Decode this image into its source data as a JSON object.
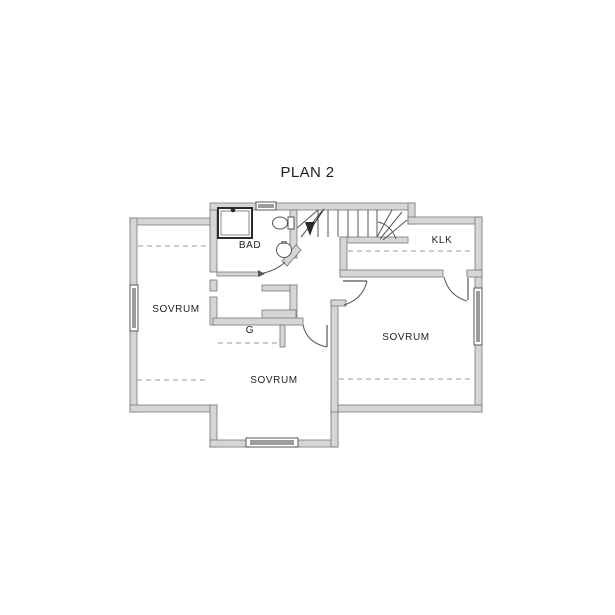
{
  "title": "PLAN 2",
  "colors": {
    "background": "#ffffff",
    "wall_fill": "#d6d6d6",
    "wall_stroke": "#767676",
    "line": "#555555",
    "dark": "#2a2a2a",
    "window_band": "#9c9c9c",
    "dashed": "#999999",
    "text": "#1f1f1f"
  },
  "rooms": [
    {
      "name": "bad",
      "label": "BAD",
      "x": 250,
      "y": 248
    },
    {
      "name": "klk",
      "label": "KLK",
      "x": 442,
      "y": 243
    },
    {
      "name": "sovrum-left",
      "label": "SOVRUM",
      "x": 176,
      "y": 312
    },
    {
      "name": "sovrum-right",
      "label": "SOVRUM",
      "x": 406,
      "y": 340
    },
    {
      "name": "sovrum-center",
      "label": "SOVRUM",
      "x": 274,
      "y": 383
    },
    {
      "name": "garderob",
      "label": "G",
      "x": 250,
      "y": 333
    }
  ],
  "plan": {
    "walls": [
      [
        130,
        218,
        87,
        7
      ],
      [
        130,
        218,
        7,
        194
      ],
      [
        130,
        405,
        87,
        7
      ],
      [
        210,
        203,
        205,
        7
      ],
      [
        408,
        203,
        7,
        21
      ],
      [
        408,
        217,
        74,
        7
      ],
      [
        475,
        217,
        7,
        195
      ],
      [
        331,
        405,
        151,
        7
      ],
      [
        210,
        405,
        7,
        42
      ],
      [
        210,
        440,
        128,
        7
      ],
      [
        331,
        405,
        7,
        42
      ],
      [
        210,
        210,
        7,
        62
      ],
      [
        210,
        280,
        7,
        11
      ],
      [
        210,
        297,
        7,
        28
      ],
      [
        290,
        210,
        7,
        48
      ],
      [
        340,
        237,
        68,
        6
      ],
      [
        340,
        237,
        7,
        40
      ],
      [
        340,
        270,
        103,
        7
      ],
      [
        467,
        270,
        15,
        7
      ],
      [
        217,
        272,
        42,
        4
      ],
      [
        262,
        285,
        35,
        6
      ],
      [
        290,
        285,
        7,
        32
      ],
      [
        262,
        310,
        34,
        14
      ],
      [
        213,
        318,
        90,
        7
      ],
      [
        280,
        325,
        5,
        22
      ],
      [
        331,
        300,
        7,
        112
      ],
      [
        331,
        300,
        15,
        6
      ]
    ],
    "diagonal_wall": "282,261 296,245 301,250 287,266",
    "stairs": {
      "treads": [
        [
          318,
          210,
          318,
          237
        ],
        [
          328,
          210,
          328,
          237
        ],
        [
          338,
          210,
          338,
          237
        ],
        [
          348,
          210,
          348,
          237
        ],
        [
          358,
          210,
          358,
          237
        ],
        [
          368,
          210,
          368,
          237
        ],
        [
          377,
          210,
          377,
          237
        ]
      ],
      "winders": [
        [
          297,
          228,
          318,
          210
        ],
        [
          301,
          237,
          322,
          211
        ],
        [
          377,
          237,
          392,
          210
        ],
        [
          380,
          239,
          402,
          212
        ],
        [
          383,
          240,
          407,
          220
        ]
      ],
      "arcs": [
        "M378,222 Q391,225 396,239"
      ],
      "walk_line": [
        310,
        230,
        324,
        209
      ],
      "arrow": "305,222 315,222 310,236"
    },
    "doors": {
      "leaves": [
        [
          327,
          325,
          327,
          347
        ],
        [
          343,
          281,
          367,
          281
        ],
        [
          468,
          278,
          468,
          300
        ]
      ],
      "arcs": [
        "M259,274 Q276,271 285,262",
        "M303,325 Q307,343 327,347",
        "M367,281 Q363,299 344,305",
        "M444,277 Q449,296 467,301"
      ],
      "swing_tick": "258,270 265,274 258,277"
    },
    "windows": [
      {
        "name": "window-top",
        "frame": [
          256,
          202,
          20,
          8
        ],
        "band": [
          258,
          204,
          16,
          4
        ]
      },
      {
        "name": "window-left",
        "frame": [
          130,
          285,
          8,
          46
        ],
        "band": [
          132,
          288,
          4,
          40
        ]
      },
      {
        "name": "window-right",
        "frame": [
          474,
          288,
          8,
          57
        ],
        "band": [
          476,
          291,
          4,
          51
        ]
      },
      {
        "name": "window-bay",
        "frame": [
          246,
          438,
          52,
          9
        ],
        "band": [
          250,
          440,
          44,
          5
        ]
      }
    ],
    "dashed_lines": [
      [
        138,
        246,
        209,
        246
      ],
      [
        137,
        380,
        209,
        380
      ],
      [
        348,
        251,
        473,
        251
      ],
      [
        339,
        379,
        473,
        379
      ],
      [
        218,
        343,
        278,
        343
      ]
    ],
    "fixtures": {
      "shower": {
        "outer": [
          218,
          208,
          34,
          30
        ],
        "inner": [
          221,
          211,
          28,
          24
        ],
        "head": [
          233,
          210,
          2.3
        ]
      },
      "toilet": {
        "bowl": [
          280,
          223,
          7.5,
          6
        ],
        "tank": [
          288,
          217,
          6,
          12
        ]
      },
      "sink": {
        "basin": [
          284,
          250,
          7.5
        ],
        "tap": [
          281,
          241,
          6,
          3
        ]
      }
    }
  }
}
